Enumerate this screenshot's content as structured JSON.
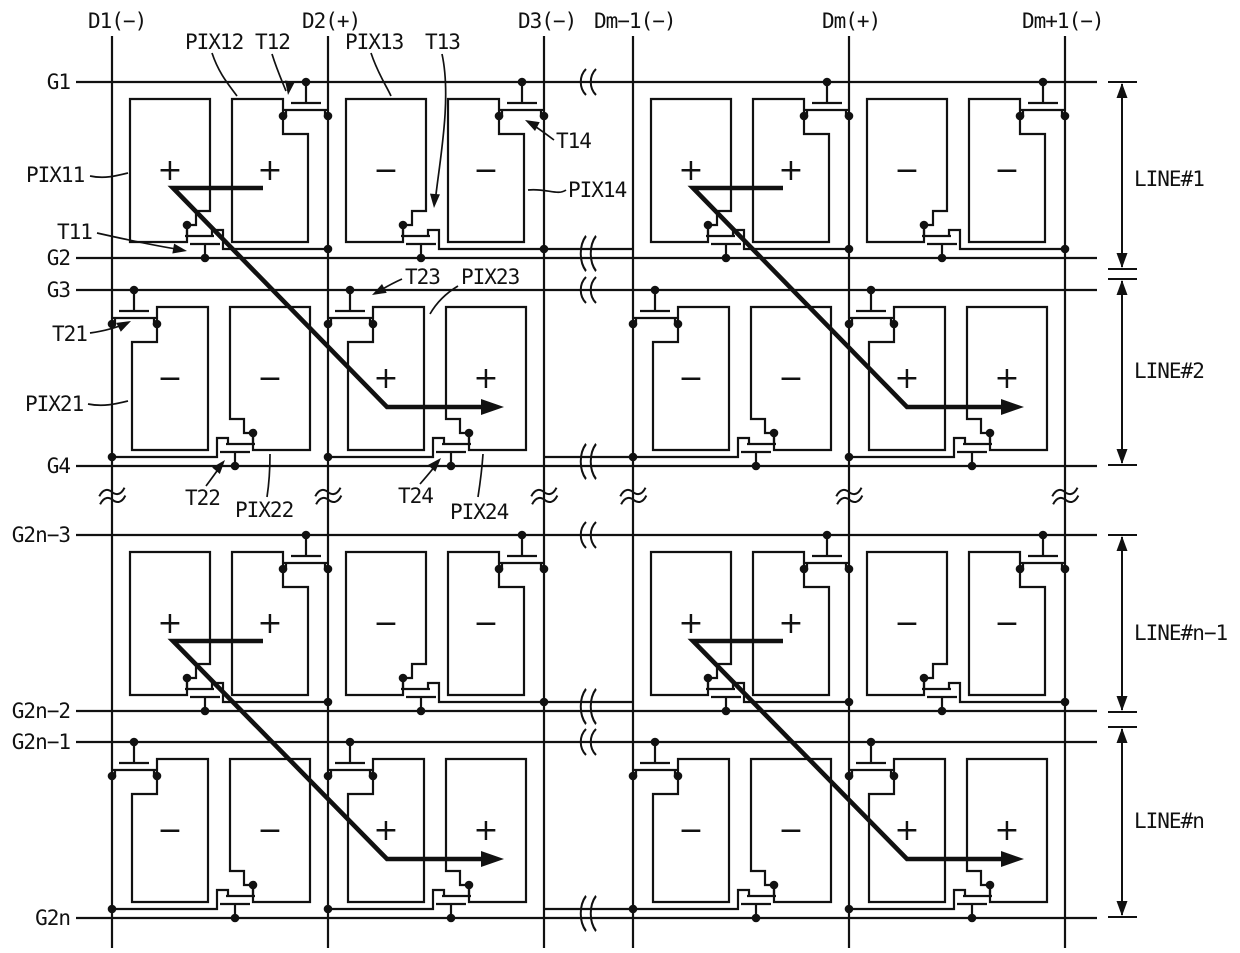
{
  "figure": {
    "background": "#ffffff",
    "ink_color": "#111111",
    "data_line_labels": [
      "D1(−)",
      "D2(+)",
      "D3(−)",
      "Dm−1(−)",
      "Dm(+)",
      "Dm+1(−)"
    ],
    "gate_line_labels": [
      "G1",
      "G2",
      "G3",
      "G4",
      "G2n−3",
      "G2n−2",
      "G2n−1",
      "G2n"
    ],
    "line_span_labels": [
      "LINE#1",
      "LINE#2",
      "LINE#n−1",
      "LINE#n"
    ],
    "component_labels": {
      "pix11": "PIX11",
      "pix12": "PIX12",
      "pix13": "PIX13",
      "pix14": "PIX14",
      "t11": "T11",
      "t12": "T12",
      "t13": "T13",
      "t14": "T14",
      "pix21": "PIX21",
      "pix22": "PIX22",
      "pix23": "PIX23",
      "pix24": "PIX24",
      "t21": "T21",
      "t22": "T22",
      "t23": "T23",
      "t24": "T24"
    },
    "polarity_rows": [
      [
        "+",
        "+",
        "−",
        "−",
        "+",
        "+",
        "−",
        "−"
      ],
      [
        "−",
        "−",
        "+",
        "+",
        "−",
        "−",
        "+",
        "+"
      ],
      [
        "+",
        "+",
        "−",
        "−",
        "+",
        "+",
        "−",
        "−"
      ],
      [
        "−",
        "−",
        "+",
        "+",
        "−",
        "−",
        "+",
        "+"
      ]
    ]
  }
}
